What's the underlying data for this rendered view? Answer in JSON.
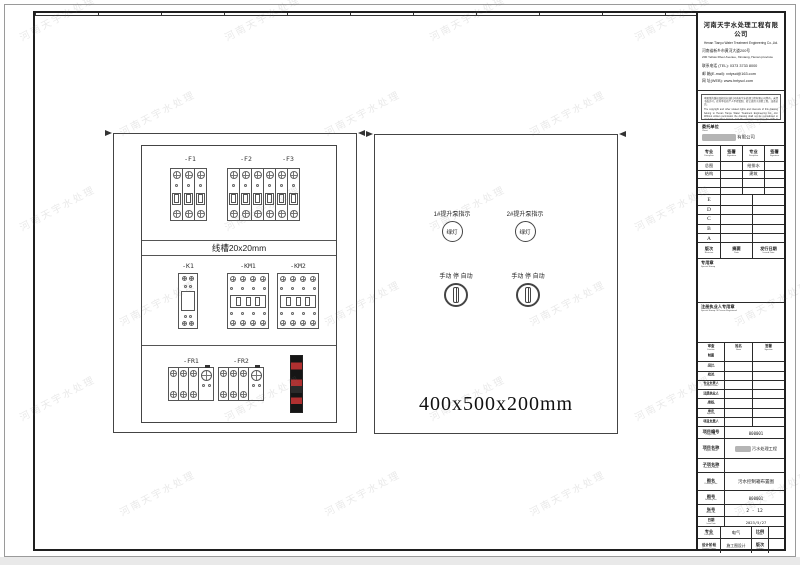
{
  "page": {
    "watermark_text": "河南天宇水处理"
  },
  "drawing": {
    "cabinet_back": {
      "breaker_group_1_labels": [
        "-F1"
      ],
      "breaker_group_2_labels": [
        "-F2",
        "-F3"
      ],
      "duct_label": "线槽20x20mm",
      "relay_label": "-K1",
      "contactor_1_label": "-KM1",
      "contactor_2_label": "-KM2",
      "thermal_1_label": "-FR1",
      "thermal_2_label": "-FR2"
    },
    "cabinet_front": {
      "indicator_1_label": "1#提升泵指示",
      "indicator_2_label": "2#提升泵指示",
      "indicator_text": "绿灯",
      "switch_1_label": "手动 停 自动",
      "switch_2_label": "手动 停 自动",
      "dimension_text": "400x500x200mm"
    }
  },
  "title_block": {
    "company_cn": "河南天宇水处理工程有限公司",
    "company_en": "Henan Tianyu Water Treatment Engineering Co.,Ltd.",
    "address_cn": "河南省新乡市黄河大道200号",
    "address_en": "200 Yellow River Avenue, Xinxiang, Henan province",
    "tel": "联系电话 (TEL): 0373 3733 8000",
    "email": "邮  箱(E-mail): xxtyscl@163.com",
    "web": "网  址(WEB): www.hntyscl.com",
    "notice_cn": "本图纸的版权及相关权益归河南天宇水处理工程有限公司所有，未经书面许可，任何单位和个人不得复制、转让或用于其他工程，违者必究。",
    "notice_en": "The copyright and other related rights and interests of this drawing belong to Henan Tianyu Water Treatment Engineering Co., Ltd. Without written permission the drawing shall not be reproduced or used for any other project, and the company reserves the right to investigate the legal liability of the infringer.",
    "client": {
      "cn": "委托单位",
      "en": "Client",
      "value_suffix": "有限公司"
    },
    "discipline_table": {
      "headers": [
        {
          "cn": "专业",
          "en": "Discipline"
        },
        {
          "cn": "签署",
          "en": "Signature"
        },
        {
          "cn": "专业",
          "en": "Discipline"
        },
        {
          "cn": "签署",
          "en": "Signature"
        }
      ],
      "rows": [
        [
          "总图",
          "",
          "给排水",
          ""
        ],
        [
          "结构",
          "",
          "建筑",
          ""
        ],
        [
          "",
          "",
          "",
          ""
        ],
        [
          "",
          "",
          "",
          ""
        ]
      ]
    },
    "revision_letters": [
      "E",
      "D",
      "C",
      "B",
      "A"
    ],
    "revision_header": [
      {
        "cn": "版次",
        "en": "Revision"
      },
      {
        "cn": "摘要",
        "en": "Date"
      },
      {
        "cn": "发行日期",
        "en": "Issued Date"
      }
    ],
    "special_stamp": {
      "cn": "专用章",
      "en": "Special Stamp"
    },
    "registered_stamp": {
      "cn": "注册执业人专用章",
      "en": "Special Stamp Of Person Registered"
    },
    "sign_table": {
      "headers": [
        {
          "cn": "审查",
          "en": "Function"
        },
        {
          "cn": "姓名",
          "en": "Name"
        },
        {
          "cn": "签署",
          "en": "Signature"
        }
      ],
      "rows": [
        {
          "cn": "制图",
          "en": "Drawn"
        },
        {
          "cn": "设计",
          "en": "Designed"
        },
        {
          "cn": "校对",
          "en": "Checked"
        },
        {
          "cn": "专业负责人",
          "en": "Discipline Leader"
        },
        {
          "cn": "注册执业人",
          "en": "Registered Person"
        },
        {
          "cn": "审核",
          "en": "Reviewed"
        },
        {
          "cn": "审定",
          "en": "Approved"
        },
        {
          "cn": "项目负责人",
          "en": "Project Leader"
        }
      ]
    },
    "fields": {
      "project_no": {
        "cn": "项目编号",
        "en": "Project No.",
        "value": "000001"
      },
      "project_name": {
        "cn": "项目名称",
        "en": "Project Name",
        "value": "污水处理工程"
      },
      "subitem_name": {
        "cn": "子项名称",
        "en": "Sub-item Name",
        "value": ""
      },
      "drawing_title": {
        "cn": "图名",
        "en": "Drawing Title",
        "value": "污水控制箱布置图"
      },
      "drawing_no": {
        "cn": "图号",
        "en": "Drawing No.",
        "value": "000001"
      },
      "sheet_no": {
        "cn": "张号",
        "en": "Sheet No.",
        "value": "2 - 12"
      },
      "issue_date": {
        "cn": "日期",
        "en": "Issue Date",
        "value": "2023/5/27"
      }
    },
    "bottom": {
      "discipline": {
        "cn": "专业",
        "en": "Discipline",
        "value": "电气"
      },
      "scale": {
        "cn": "比例",
        "en": "Scale",
        "value": ""
      },
      "stage": {
        "cn": "设计阶段",
        "en": "Design Phase",
        "value": "施工图设计"
      },
      "edition": {
        "cn": "版次",
        "en": "Edition",
        "value": ""
      }
    }
  }
}
